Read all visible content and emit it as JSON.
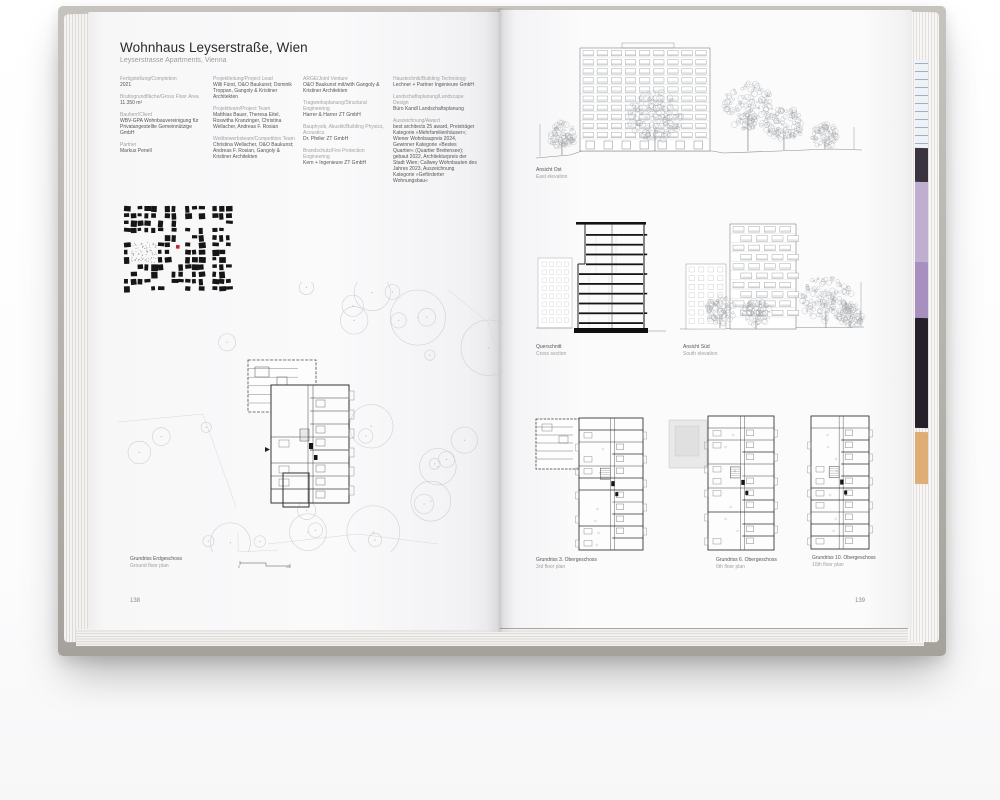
{
  "header": {
    "title": "Wohnhaus Leyserstraße, Wien",
    "subtitle": "Leyserstrasse Apartments, Vienna"
  },
  "book": {
    "left_page_number": "138",
    "right_page_number": "139"
  },
  "meta_columns": [
    {
      "entries": [
        {
          "label": "Fertigstellung/Completion",
          "value": "2021"
        },
        {
          "label": "Bruttogrundfläche/Gross Floor Area",
          "value": "11.350 m²"
        },
        {
          "label": "Bauherr/Client",
          "value": "WBV-GPA Wohnbauvereinigung für Privatangestellte Gemeinnützige GmbH"
        },
        {
          "label": "Partner",
          "value": "Markus Penell"
        }
      ]
    },
    {
      "entries": [
        {
          "label": "Projektleitung/Project Lead",
          "value": "Willi Fürst, O&O Baukunst; Dominik Troppan, Gangoly & Kristiner Architekten"
        },
        {
          "label": "Projektteam/Project Team",
          "value": "Matthias Bauer, Theresa Eitel, Roswitha Kranzinger, Christina Wellacher, Andreas F. Rosian"
        },
        {
          "label": "Wettbewerbsteam/Competition Team",
          "value": "Christina Wellacher, O&O Baukunst; Andreas F. Rosian, Gangoly & Kristiner Architekten"
        }
      ]
    },
    {
      "entries": [
        {
          "label": "ARGE/Joint Venture",
          "value": "O&O Baukunst mit/with Gangoly & Kristiner Architekten"
        },
        {
          "label": "Tragwerksplanung/Structural Engineering",
          "value": "Harrer & Harrer ZT GmbH"
        },
        {
          "label": "Bauphysik, Akustik/Building Physics, Acoustics",
          "value": "Dr. Pfeiler ZT GmbH"
        },
        {
          "label": "Brandschutz/Fire Protection Engineering",
          "value": "Kern + Ingenieure ZT GmbH"
        }
      ]
    },
    {
      "entries": [
        {
          "label": "Haustechnik/Building Technology",
          "value": "Lechner + Partner Ingenieure GmbH"
        },
        {
          "label": "Landschaftsplanung/Landscape Design",
          "value": "Büro Kandl Landschaftsplanung"
        },
        {
          "label": "Auszeichnung/Award",
          "value": "best architects 25 award, Preisträger Kategorie »Mehrfamilienhäuser«; Wiener Wohnbaupreis 2024, Gewinner Kategorie »Bestes Quartier« (Quartier Breitensee); gebaut 2022, Architekturpreis der Stadt Wien; Callwey Wohnbauten des Jahres 2023, Auszeichnung Kategorie »Geförderter Wohnungsbau«"
        }
      ]
    }
  ],
  "captions": {
    "ground_floor": {
      "de": "Grundriss Erdgeschoss",
      "en": "Ground floor plan"
    },
    "east_elevation": {
      "de": "Ansicht Ost",
      "en": "East elevation"
    },
    "cross_section": {
      "de": "Querschnitt",
      "en": "Cross section"
    },
    "south_elevation": {
      "de": "Ansicht Süd",
      "en": "South elevation"
    },
    "floor3": {
      "de": "Grundriss 3. Obergeschoss",
      "en": "3rd floor plan"
    },
    "floor6": {
      "de": "Grundriss 6. Obergeschoss",
      "en": "6th floor plan"
    },
    "floor10": {
      "de": "Grundriss 10. Obergeschoss",
      "en": "10th floor plan"
    }
  },
  "scale_bar": {
    "start": "0",
    "end": "20"
  },
  "colors": {
    "ink": "#2a2a2a",
    "label_gray": "#a2a2a2",
    "drawing_light": "#9aa0a3",
    "drawing_faint": "#cbcdd0",
    "drawing_dark": "#3c3c3c",
    "section_black": "#141414",
    "map_black": "#161616",
    "marker_red": "#c1272d",
    "roof_gray": "#e9e9e9",
    "edge_slivers": {
      "dark_top": "#3a3340",
      "lavender": "#c0aed0",
      "purple": "#a78fc0",
      "black": "#25202a",
      "tan": "#dfae74"
    }
  }
}
